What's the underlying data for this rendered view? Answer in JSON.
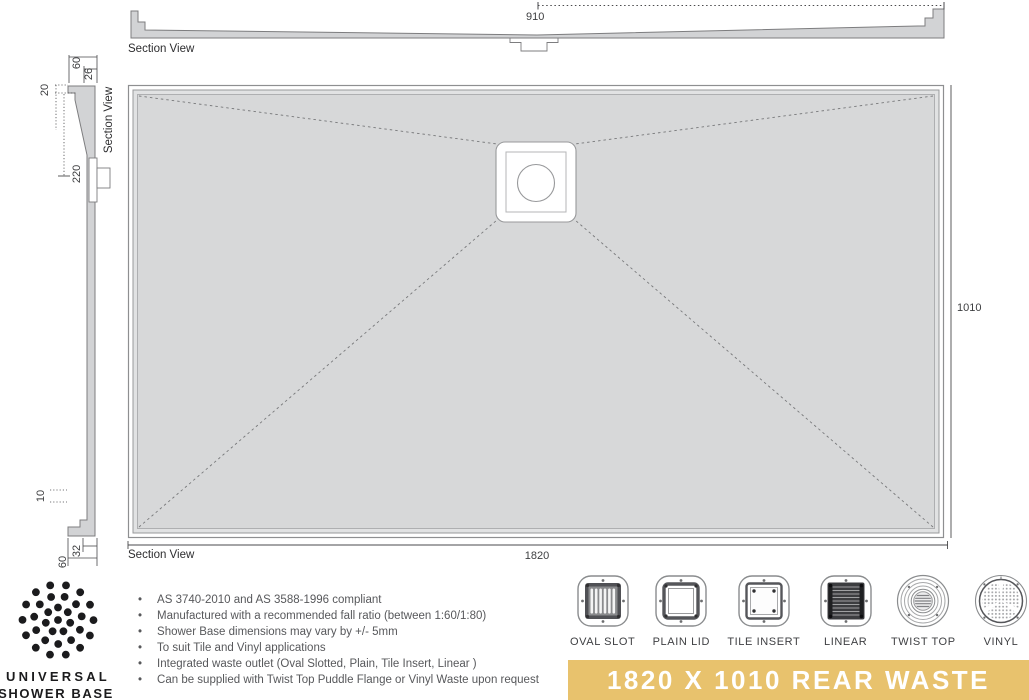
{
  "views": {
    "top_section": {
      "label": "Section View",
      "dim_width": "910"
    },
    "side_section": {
      "label": "Section View",
      "dims": {
        "top_total": "60",
        "top_inner": "26",
        "top_lip": "20",
        "waste_offset": "220",
        "bottom_lip": "10",
        "bottom_inner": "32",
        "bottom_total": "60"
      }
    },
    "plan": {
      "section_label": "Section View",
      "dim_length": "1820",
      "dim_width": "1010"
    }
  },
  "notes": [
    "AS 3740-2010 and AS 3588-1996 compliant",
    "Manufactured with a recommended fall ratio (between 1:60/1:80)",
    "Shower Base dimensions may vary by +/- 5mm",
    "To suit Tile and Vinyl applications",
    "Integrated waste outlet (Oval Slotted, Plain, Tile Insert, Linear )",
    "Can be supplied with Twist Top Puddle Flange or Vinyl Waste upon request"
  ],
  "waste_options": [
    {
      "label": "OVAL SLOT",
      "icon": "oval-slot-icon"
    },
    {
      "label": "PLAIN LID",
      "icon": "plain-lid-icon"
    },
    {
      "label": "TILE INSERT",
      "icon": "tile-insert-icon"
    },
    {
      "label": "LINEAR",
      "icon": "linear-icon"
    },
    {
      "label": "TWIST TOP",
      "icon": "twist-top-icon"
    },
    {
      "label": "VINYL",
      "icon": "vinyl-icon"
    }
  ],
  "brand": {
    "line1": "UNIVERSAL",
    "line2": "SHOWER BASE"
  },
  "banner": {
    "label": "1820 X 1010 REAR WASTE",
    "background": "#e8c26d",
    "text_color": "#ffffff"
  },
  "colors": {
    "base_fill": "#d7d8d9",
    "outline": "#7d7d7f",
    "accent_gold": "#e8c26d"
  }
}
